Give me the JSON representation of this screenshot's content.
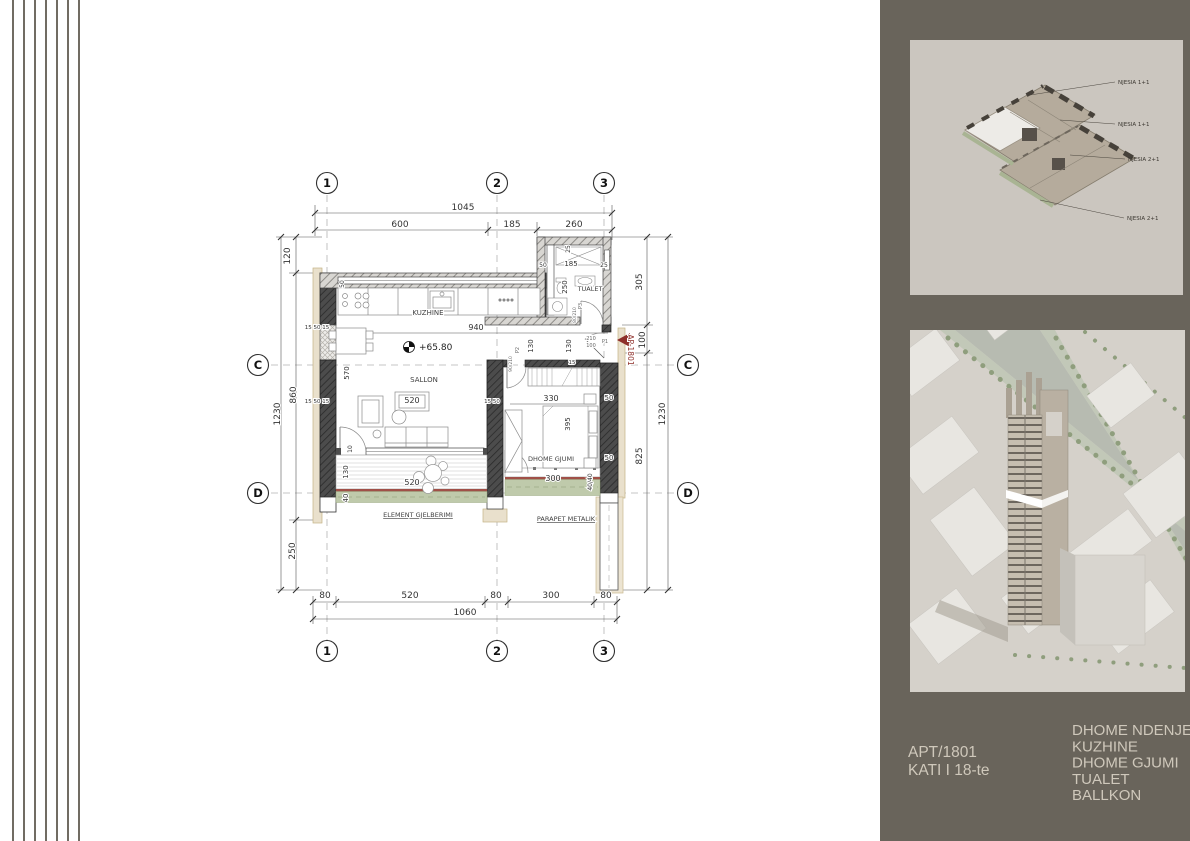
{
  "colors": {
    "panel_background": "#69645b",
    "accent_red": "#8e2f2a",
    "balcony_green": "#bfcaab",
    "parapet_red": "#a05048",
    "panel_text": "#cfc8bb",
    "drawing_line": "#444444"
  },
  "plan": {
    "title_context": "apartment floor plan",
    "grid": {
      "cols": [
        {
          "label": "1",
          "x": 327
        },
        {
          "label": "2",
          "x": 497
        },
        {
          "label": "3",
          "x": 604
        }
      ],
      "rows": [
        {
          "label": "C",
          "y": 365
        },
        {
          "label": "D",
          "y": 493
        }
      ],
      "top_y": 183,
      "bottom_y": 651,
      "left_x": 258,
      "right_x": 688
    },
    "level_marker": "+65.80",
    "apartment_marker": "AP-1801",
    "labels": [
      {
        "t": "1045",
        "x": 463,
        "y": 210,
        "s": 9,
        "n": "dim-top-total"
      },
      {
        "t": "600",
        "x": 400,
        "y": 227,
        "s": 9,
        "n": "dim-top-600"
      },
      {
        "t": "185",
        "x": 512,
        "y": 227,
        "s": 9,
        "n": "dim-top-185"
      },
      {
        "t": "260",
        "x": 574,
        "y": 227,
        "s": 9,
        "n": "dim-top-260"
      },
      {
        "t": "120",
        "x": 290,
        "y": 256,
        "s": 9,
        "rot": -90,
        "n": "dim-left-120"
      },
      {
        "t": "860",
        "x": 296,
        "y": 395,
        "s": 9,
        "rot": -90,
        "n": "dim-left-860"
      },
      {
        "t": "1230",
        "x": 280,
        "y": 414,
        "s": 9,
        "rot": -90,
        "n": "dim-left-total"
      },
      {
        "t": "250",
        "x": 295,
        "y": 551,
        "s": 9,
        "rot": -90,
        "n": "dim-left-250"
      },
      {
        "t": "305",
        "x": 642,
        "y": 282,
        "s": 9,
        "rot": -90,
        "n": "dim-right-305"
      },
      {
        "t": "100",
        "x": 645,
        "y": 340,
        "s": 9,
        "rot": -90,
        "n": "dim-right-100"
      },
      {
        "t": "825",
        "x": 642,
        "y": 456,
        "s": 9,
        "rot": -90,
        "n": "dim-right-825"
      },
      {
        "t": "1230",
        "x": 665,
        "y": 414,
        "s": 9,
        "rot": -90,
        "n": "dim-right-total"
      },
      {
        "t": "80",
        "x": 325,
        "y": 598,
        "s": 9,
        "n": "dim-bottom-80a"
      },
      {
        "t": "520",
        "x": 410,
        "y": 598,
        "s": 9,
        "n": "dim-bottom-520"
      },
      {
        "t": "80",
        "x": 496,
        "y": 598,
        "s": 9,
        "n": "dim-bottom-80b"
      },
      {
        "t": "300",
        "x": 551,
        "y": 598,
        "s": 9,
        "n": "dim-bottom-300"
      },
      {
        "t": "80",
        "x": 606,
        "y": 598,
        "s": 9,
        "n": "dim-bottom-80c"
      },
      {
        "t": "1060",
        "x": 465,
        "y": 615,
        "s": 9,
        "n": "dim-bottom-total"
      },
      {
        "t": "940",
        "x": 476,
        "y": 330,
        "s": 8,
        "n": "dim-kitchen-940"
      },
      {
        "t": "130",
        "x": 533,
        "y": 346,
        "s": 7,
        "rot": -90,
        "n": "dim-corridor-130a"
      },
      {
        "t": "130",
        "x": 571,
        "y": 346,
        "s": 7,
        "rot": -90,
        "n": "dim-corridor-130b"
      },
      {
        "t": "570",
        "x": 349,
        "y": 373,
        "s": 7,
        "rot": -90,
        "n": "dim-sallon-570"
      },
      {
        "t": "520",
        "x": 412,
        "y": 403,
        "s": 8,
        "n": "dim-sallon-520"
      },
      {
        "t": "520",
        "x": 412,
        "y": 485,
        "s": 8,
        "n": "dim-balcony-520"
      },
      {
        "t": "130",
        "x": 348,
        "y": 472,
        "s": 7,
        "rot": -90,
        "n": "dim-balcony-130"
      },
      {
        "t": "40",
        "x": 348,
        "y": 498,
        "s": 7,
        "rot": -90,
        "n": "dim-balcony-40"
      },
      {
        "t": "10",
        "x": 352,
        "y": 449,
        "s": 6,
        "rot": -90,
        "n": "dim-balcony-10"
      },
      {
        "t": "330",
        "x": 551,
        "y": 401,
        "s": 8,
        "n": "dim-bedroom-330"
      },
      {
        "t": "395",
        "x": 570,
        "y": 424,
        "s": 7,
        "rot": -90,
        "n": "dim-bed-395"
      },
      {
        "t": "300",
        "x": 553,
        "y": 481,
        "s": 8,
        "n": "dim-bedroom-balcony-300"
      },
      {
        "t": "40/40",
        "x": 592,
        "y": 482,
        "s": 6,
        "rot": -90,
        "n": "dim-bedroom-balcony-40-40"
      },
      {
        "t": "50",
        "x": 609,
        "y": 400,
        "s": 7,
        "n": "dim-wall-50a"
      },
      {
        "t": "50",
        "x": 609,
        "y": 460,
        "s": 7,
        "n": "dim-wall-50b"
      },
      {
        "t": "15 50 15",
        "x": 317,
        "y": 329,
        "s": 5.5,
        "n": "dim-wall-155015a"
      },
      {
        "t": "15 50 15",
        "x": 317,
        "y": 403,
        "s": 5.5,
        "n": "dim-wall-155015b"
      },
      {
        "t": "15 50",
        "x": 492,
        "y": 403,
        "s": 5.5,
        "n": "dim-wall-1550"
      },
      {
        "t": "15",
        "x": 572,
        "y": 364,
        "s": 5.5,
        "n": "dim-wall-15"
      },
      {
        "t": "50",
        "x": 344,
        "y": 284,
        "s": 6,
        "rot": -90,
        "n": "dim-kitchen-wall-50"
      },
      {
        "t": "50",
        "x": 543,
        "y": 267,
        "s": 6,
        "n": "dim-tualet-50"
      },
      {
        "t": "185",
        "x": 571,
        "y": 266,
        "s": 7,
        "n": "dim-tualet-185"
      },
      {
        "t": "25",
        "x": 604,
        "y": 267,
        "s": 6,
        "n": "dim-tualet-25a"
      },
      {
        "t": "25",
        "x": 570,
        "y": 249,
        "s": 6,
        "rot": -90,
        "n": "dim-tualet-25b"
      },
      {
        "t": "250",
        "x": 567,
        "y": 287,
        "s": 7,
        "rot": -90,
        "n": "dim-tualet-250"
      },
      {
        "t": "TUALET",
        "x": 590,
        "y": 291,
        "s": 6.5,
        "c": "#3f3f3f",
        "n": "room-label-tualet"
      },
      {
        "t": "P3",
        "x": 582,
        "y": 306,
        "s": 5,
        "rot": -90,
        "c": "#666666",
        "n": "door-label-p3"
      },
      {
        "t": "80/210",
        "x": 576,
        "y": 315,
        "s": 4.5,
        "rot": -90,
        "c": "#666666",
        "n": "door-size-p3"
      },
      {
        "t": "210",
        "x": 591,
        "y": 340,
        "s": 5,
        "c": "#666666",
        "n": "door-size-p1-a"
      },
      {
        "t": "100",
        "x": 591,
        "y": 347,
        "s": 5,
        "c": "#666666",
        "n": "door-size-p1-b"
      },
      {
        "t": "P1",
        "x": 605,
        "y": 343,
        "s": 5,
        "c": "#666666",
        "n": "door-label-p1"
      },
      {
        "t": "90/210",
        "x": 512,
        "y": 364,
        "s": 4.5,
        "rot": -90,
        "c": "#666666",
        "n": "door-size-p2"
      },
      {
        "t": "P2",
        "x": 519,
        "y": 350,
        "s": 5,
        "rot": -90,
        "c": "#666666",
        "n": "door-label-p2"
      },
      {
        "t": "KUZHINE",
        "x": 428,
        "y": 315,
        "s": 7,
        "c": "#3f3f3f",
        "n": "room-label-kuzhine"
      },
      {
        "t": "SALLON",
        "x": 424,
        "y": 382,
        "s": 7,
        "c": "#3f3f3f",
        "n": "room-label-sallon"
      },
      {
        "t": "DHOME GJUMI",
        "x": 551,
        "y": 461,
        "s": 6.5,
        "c": "#3f3f3f",
        "n": "room-label-dhome-gjumi"
      },
      {
        "t": "+65.80",
        "x": 419,
        "y": 350,
        "s": 9,
        "c": "#222222",
        "a": "start",
        "n": "level-marker-label"
      },
      {
        "t": "ELEMENT GJELBERIMI",
        "x": 418,
        "y": 517,
        "s": 6.5,
        "c": "#3f3f3f",
        "u": 1,
        "n": "annotation-element-gjelberimi"
      },
      {
        "t": "PARAPET METALIK",
        "x": 566,
        "y": 521,
        "s": 6.5,
        "c": "#3f3f3f",
        "u": 1,
        "n": "annotation-parapet-metalik"
      },
      {
        "t": "AP-1801",
        "x": 628,
        "y": 350,
        "s": 7.5,
        "rot": 90,
        "c": "#8e2f2a",
        "n": "apartment-marker-label"
      }
    ]
  },
  "side_panel": {
    "top_image": {
      "description": "axonometric floor plate with unit labels",
      "unit_labels": [
        {
          "t": "NJESIA 1+1",
          "x": 1118,
          "y": 84,
          "lx": 1030,
          "ly": 95
        },
        {
          "t": "NJESIA 1+1",
          "x": 1118,
          "y": 126,
          "lx": 1060,
          "ly": 120
        },
        {
          "t": "NJESIA 2+1",
          "x": 1128,
          "y": 161,
          "lx": 1070,
          "ly": 155
        },
        {
          "t": "NJESIA 2+1",
          "x": 1127,
          "y": 220,
          "lx": 1040,
          "ly": 200
        }
      ]
    },
    "bottom_image": {
      "description": "aerial render of tower with highlighted 18th floor"
    },
    "footer": {
      "apartment": "APT/1801",
      "floor": "KATI I 18-te",
      "rooms": [
        "DHOME NDENJE",
        "KUZHINE",
        "DHOME GJUMI",
        "TUALET",
        "BALLKON"
      ]
    }
  }
}
